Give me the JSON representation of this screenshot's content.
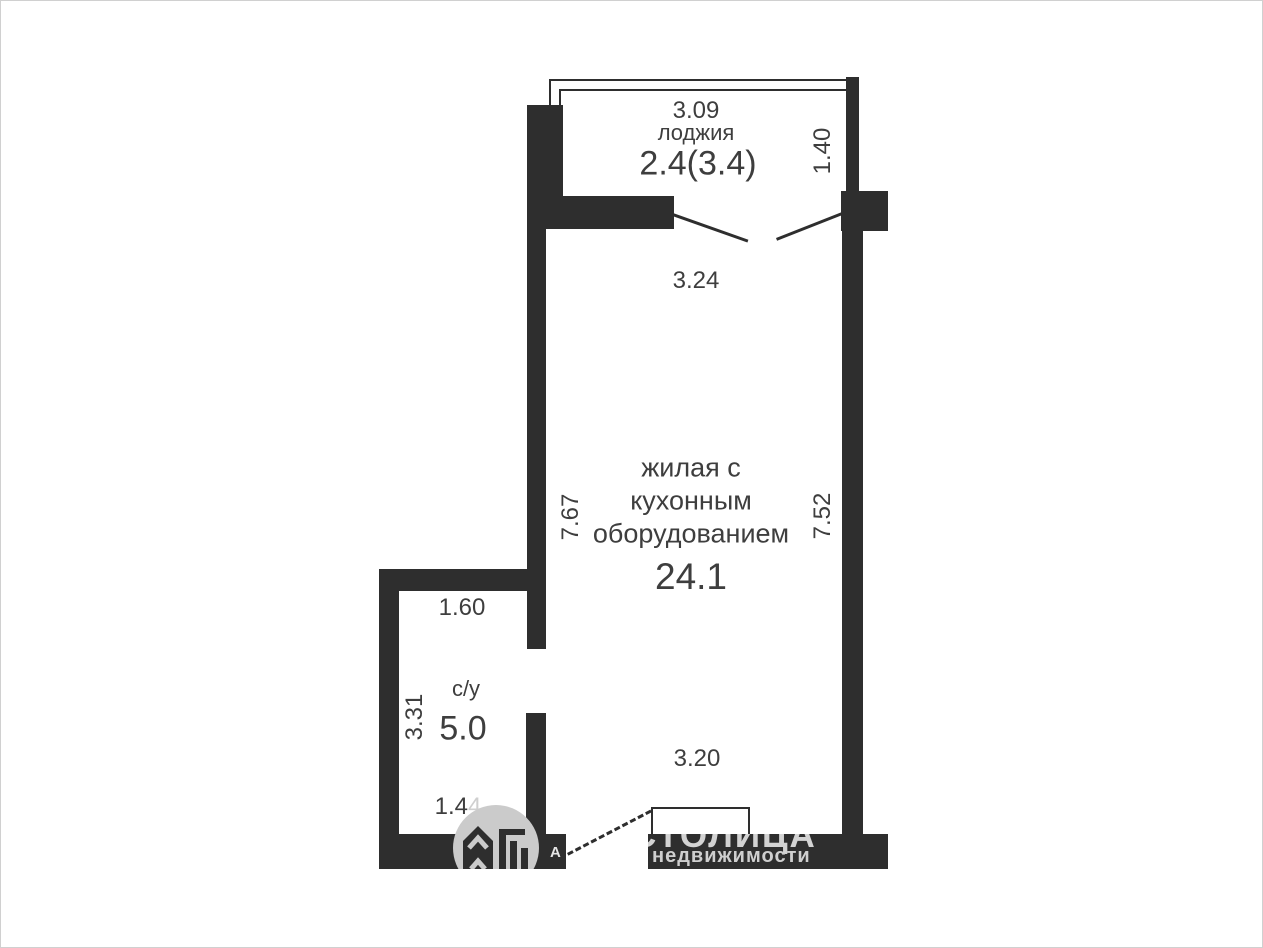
{
  "rooms": {
    "loggia": {
      "label": "лоджия",
      "area": "2.4(3.4)",
      "dim_top": "3.09",
      "dim_right": "1.40"
    },
    "living": {
      "label_lines": [
        "жилая с",
        "кухонным",
        "оборудованием"
      ],
      "area": "24.1",
      "dim_top": "3.24",
      "dim_left": "7.67",
      "dim_right": "7.52",
      "dim_bottom": "3.20"
    },
    "bathroom": {
      "label": "с/у",
      "area": "5.0",
      "dim_top": "1.60",
      "dim_left": "3.31",
      "dim_bottom_main": "1.4",
      "dim_bottom_faded": "4"
    }
  },
  "watermark": {
    "brand": "СТОЛИЦА",
    "agency_initial": "А",
    "agency_word": "недвижимости",
    "logo_icon": "house-with-bars-icon"
  },
  "colors": {
    "wall": "#2e2e2e",
    "text": "#3e3e3e",
    "watermark_gray": "#cbcbcb"
  }
}
